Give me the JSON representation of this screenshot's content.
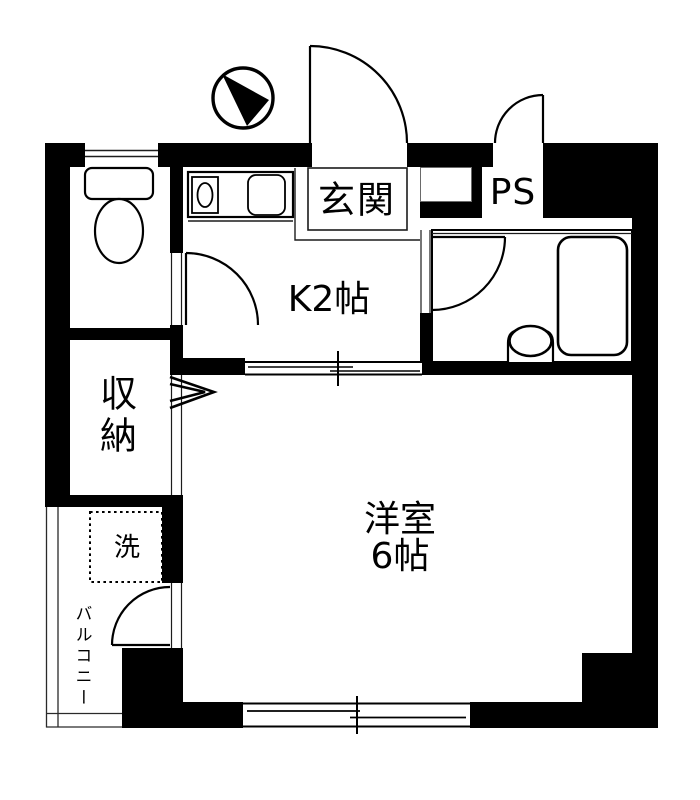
{
  "document": {
    "kind": "apartment-floor-plan"
  },
  "labels": {
    "genkan": "玄関",
    "pipe_space": "PS",
    "kitchen": "K2帖",
    "western_room_name": "洋室",
    "western_room_size": "6帖",
    "storage": "収納",
    "washing_machine": "洗",
    "balcony": "バルコニー"
  },
  "icons": {
    "compass": "compass-icon",
    "toilet": "toilet-icon",
    "stove": "stove-burner-icon",
    "kitchen_sink": "kitchen-sink-icon",
    "bathtub": "bathtub-icon",
    "washbasin": "washbasin-icon",
    "washing_machine_pan": "washing-machine-pan-icon",
    "entrance_door": "door-swing-icon",
    "sliding_window": "sliding-window-icon"
  },
  "colors": {
    "wall": "#000000",
    "background": "#ffffff",
    "thin_line": "#1c1c1c"
  }
}
